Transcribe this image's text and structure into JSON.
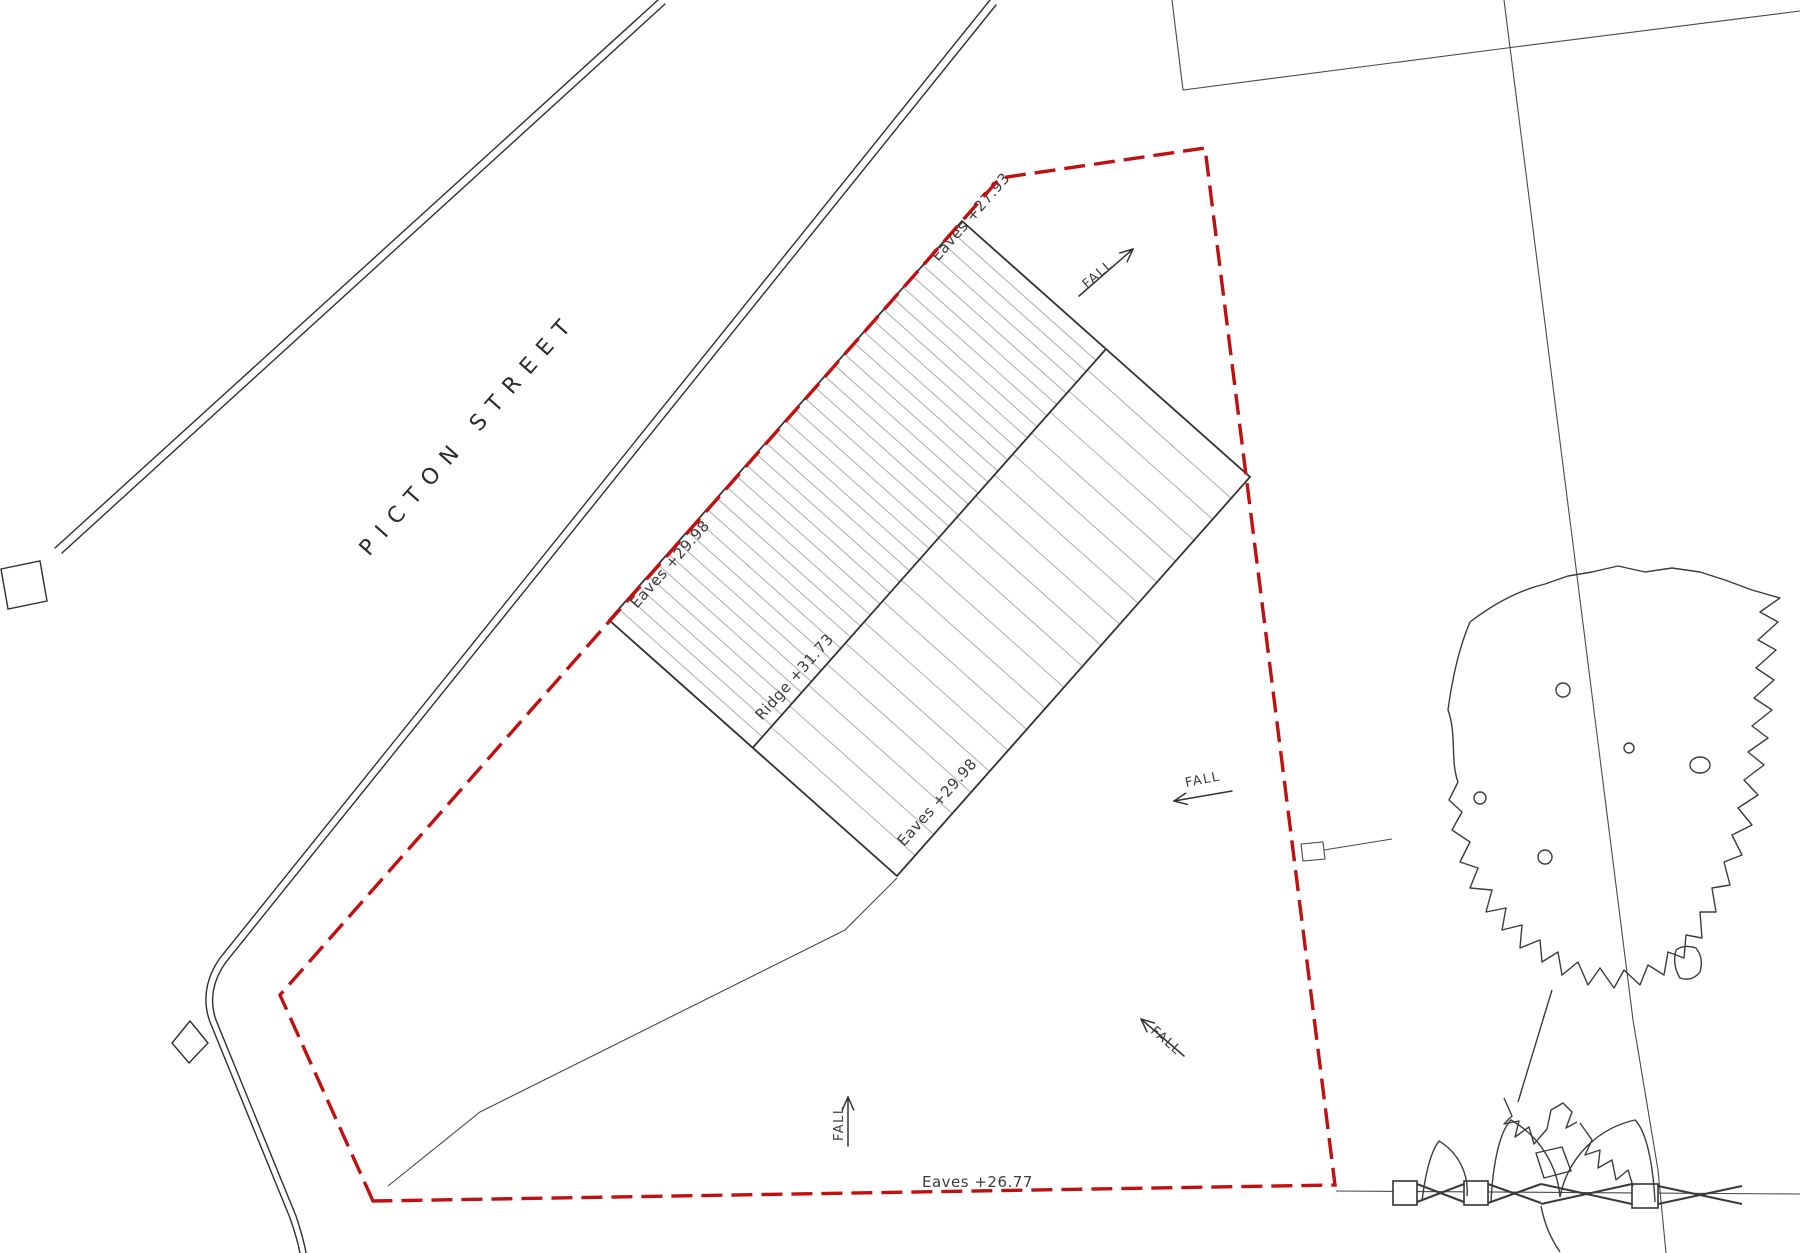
{
  "street": {
    "name": "PICTON STREET"
  },
  "roof_labels": {
    "eaves_boundary": "Eaves +27.93",
    "eaves_upper": "Eaves +29.98",
    "ridge": "Ridge +31.73",
    "eaves_lower": "Eaves +29.98"
  },
  "site_labels": {
    "eaves_rear": "Eaves +26.77",
    "fall_1": "FALL",
    "fall_2": "FALL",
    "fall_3": "FALL",
    "fall_4": "FALL"
  },
  "colors": {
    "boundary_red": "#c01010",
    "line": "#2f2f2f",
    "hatch": "#b3b3b3",
    "text": "#3d3d3d",
    "background": "#ffffff"
  }
}
